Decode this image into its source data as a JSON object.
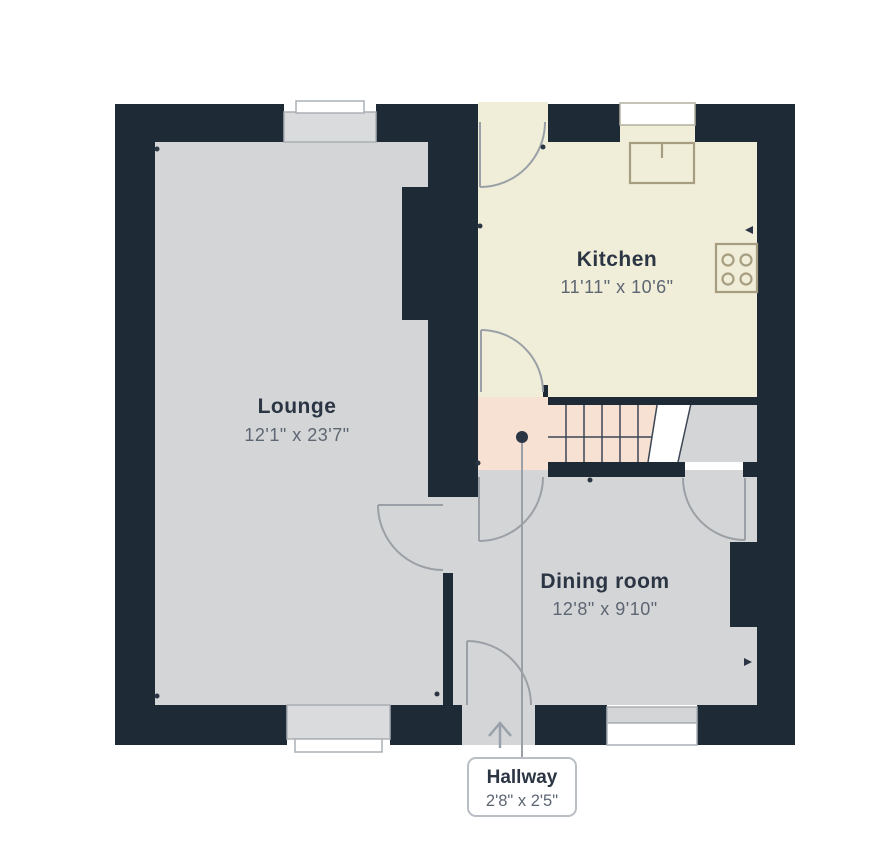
{
  "title": "Ground floor plan",
  "colors": {
    "wall": "#1f2a37",
    "floor_gray": "#d4d5d6",
    "kitchen_floor": "#f0edd8",
    "hallway_floor": "#f7e1d3",
    "door_line": "#9aa0a6",
    "fixture_line": "#a79e82",
    "room_name_text": "#2b3544",
    "dims_text": "#5d6673",
    "window_white": "#ffffff"
  },
  "rooms": [
    {
      "id": "lounge",
      "name": "Lounge",
      "dims": "12'1\" x 23'7\""
    },
    {
      "id": "kitchen",
      "name": "Kitchen",
      "dims": "11'11\" x 10'6\""
    },
    {
      "id": "dining",
      "name": "Dining room",
      "dims": "12'8\" x 9'10\""
    }
  ],
  "hallway_label": {
    "name": "Hallway",
    "dims": "2'8\" x 2'5\""
  },
  "icons": {
    "sink": "kitchen-sink",
    "hob": "four-ring-hob",
    "stairs": "staircase-up",
    "entrance": "entrance-arrow"
  }
}
